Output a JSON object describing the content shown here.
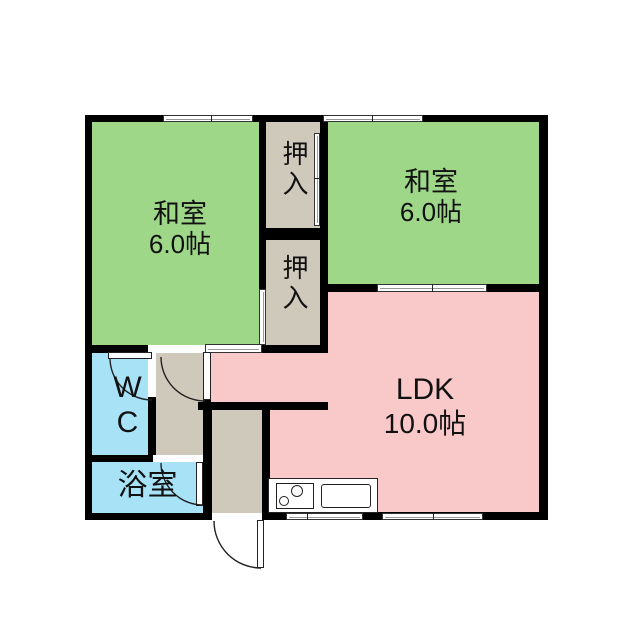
{
  "floorplan": {
    "rooms": [
      {
        "name": "和室",
        "area": "6.0帖"
      },
      {
        "name": "押入"
      },
      {
        "name": "和室",
        "area": "6.0帖"
      },
      {
        "name": "押入"
      },
      {
        "name": "LDK",
        "area": "10.0帖"
      },
      {
        "name": "WC"
      },
      {
        "name": "浴室"
      }
    ],
    "colors": {
      "tatami_room": "#9fd789",
      "ldk": "#f9c9c9",
      "wet_area": "#a8e2f6",
      "closet_hall": "#cfc9bc",
      "wall": "#000000",
      "background": "#ffffff",
      "outline": "#222222"
    }
  }
}
